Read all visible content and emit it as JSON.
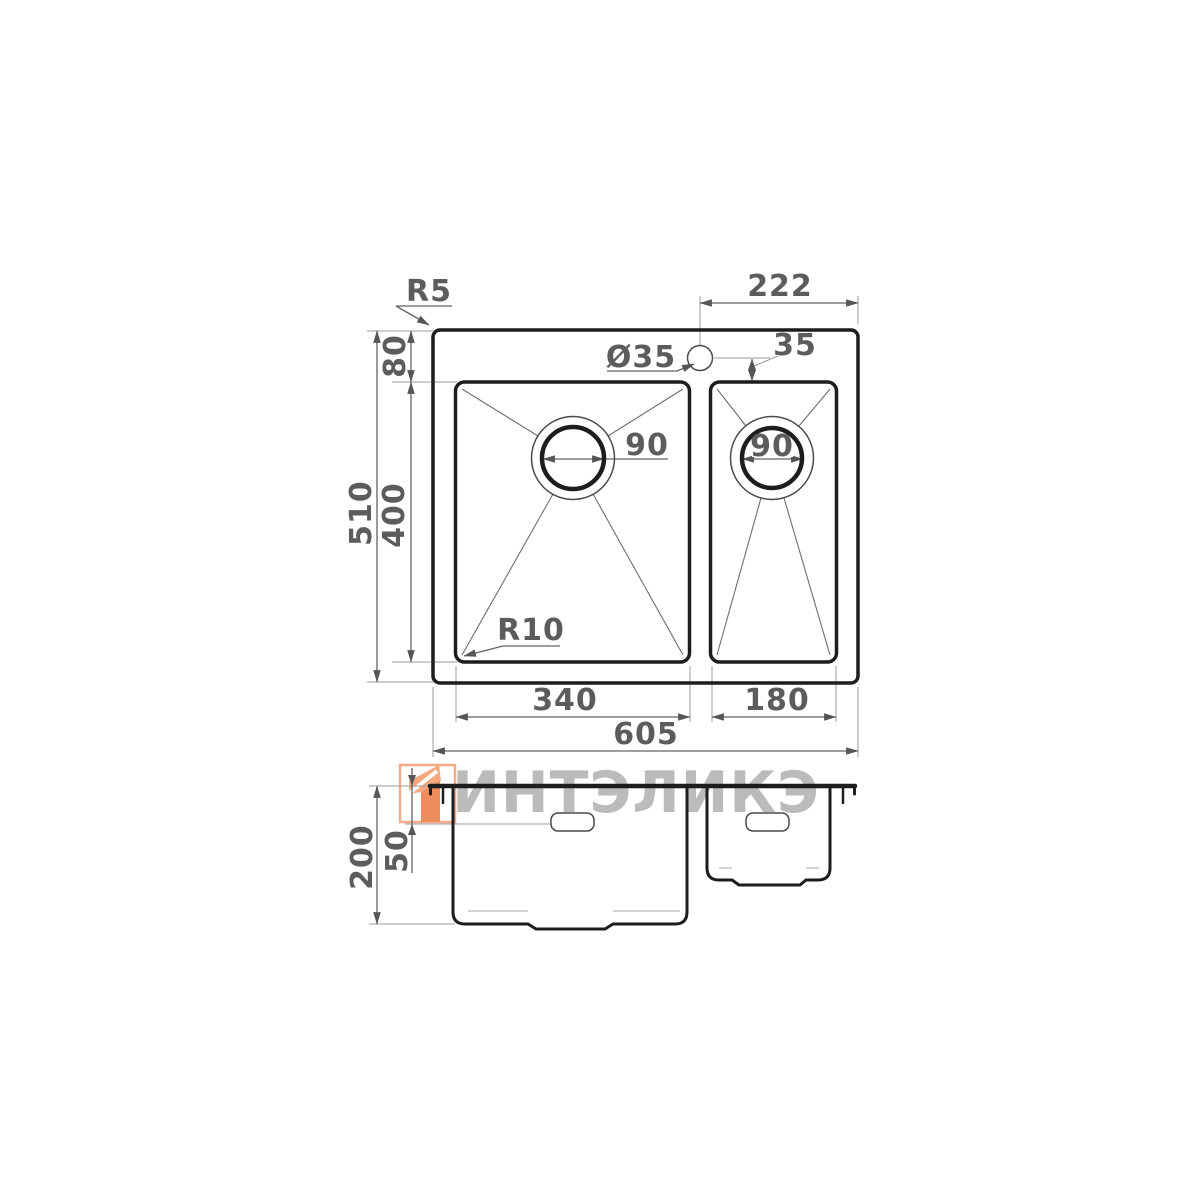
{
  "watermark": {
    "text": "ИНТЭЛИКЭ",
    "logo": "intalika-logo",
    "text_color": "#b4b4b4",
    "logo_border_color": "#f6aa88",
    "logo_fill_light": "#f5a87e",
    "logo_fill_dark": "#ef8c5e"
  },
  "colors": {
    "outline": "#1d1d1d",
    "dimension_lines": "#636363",
    "extension_lines": "#9b9b9b",
    "dimension_text": "#5c5c5c",
    "background": "#ffffff"
  },
  "drawing": {
    "top_view": {
      "corner_radius_label": "R5",
      "faucet_to_right_edge": "222",
      "edge_to_bowl_top": "80",
      "faucet_hole_diameter": "Ø35",
      "faucet_to_small_bowl": "35",
      "main_drain_diameter": "90",
      "small_drain_diameter": "90",
      "overall_depth": "510",
      "bowl_depth": "400",
      "bowl_corner_radius_label": "R10",
      "main_bowl_width": "340",
      "small_bowl_width": "180",
      "overall_width": "605"
    },
    "section_view": {
      "bowl_height": "200",
      "overflow_offset": "50"
    }
  }
}
